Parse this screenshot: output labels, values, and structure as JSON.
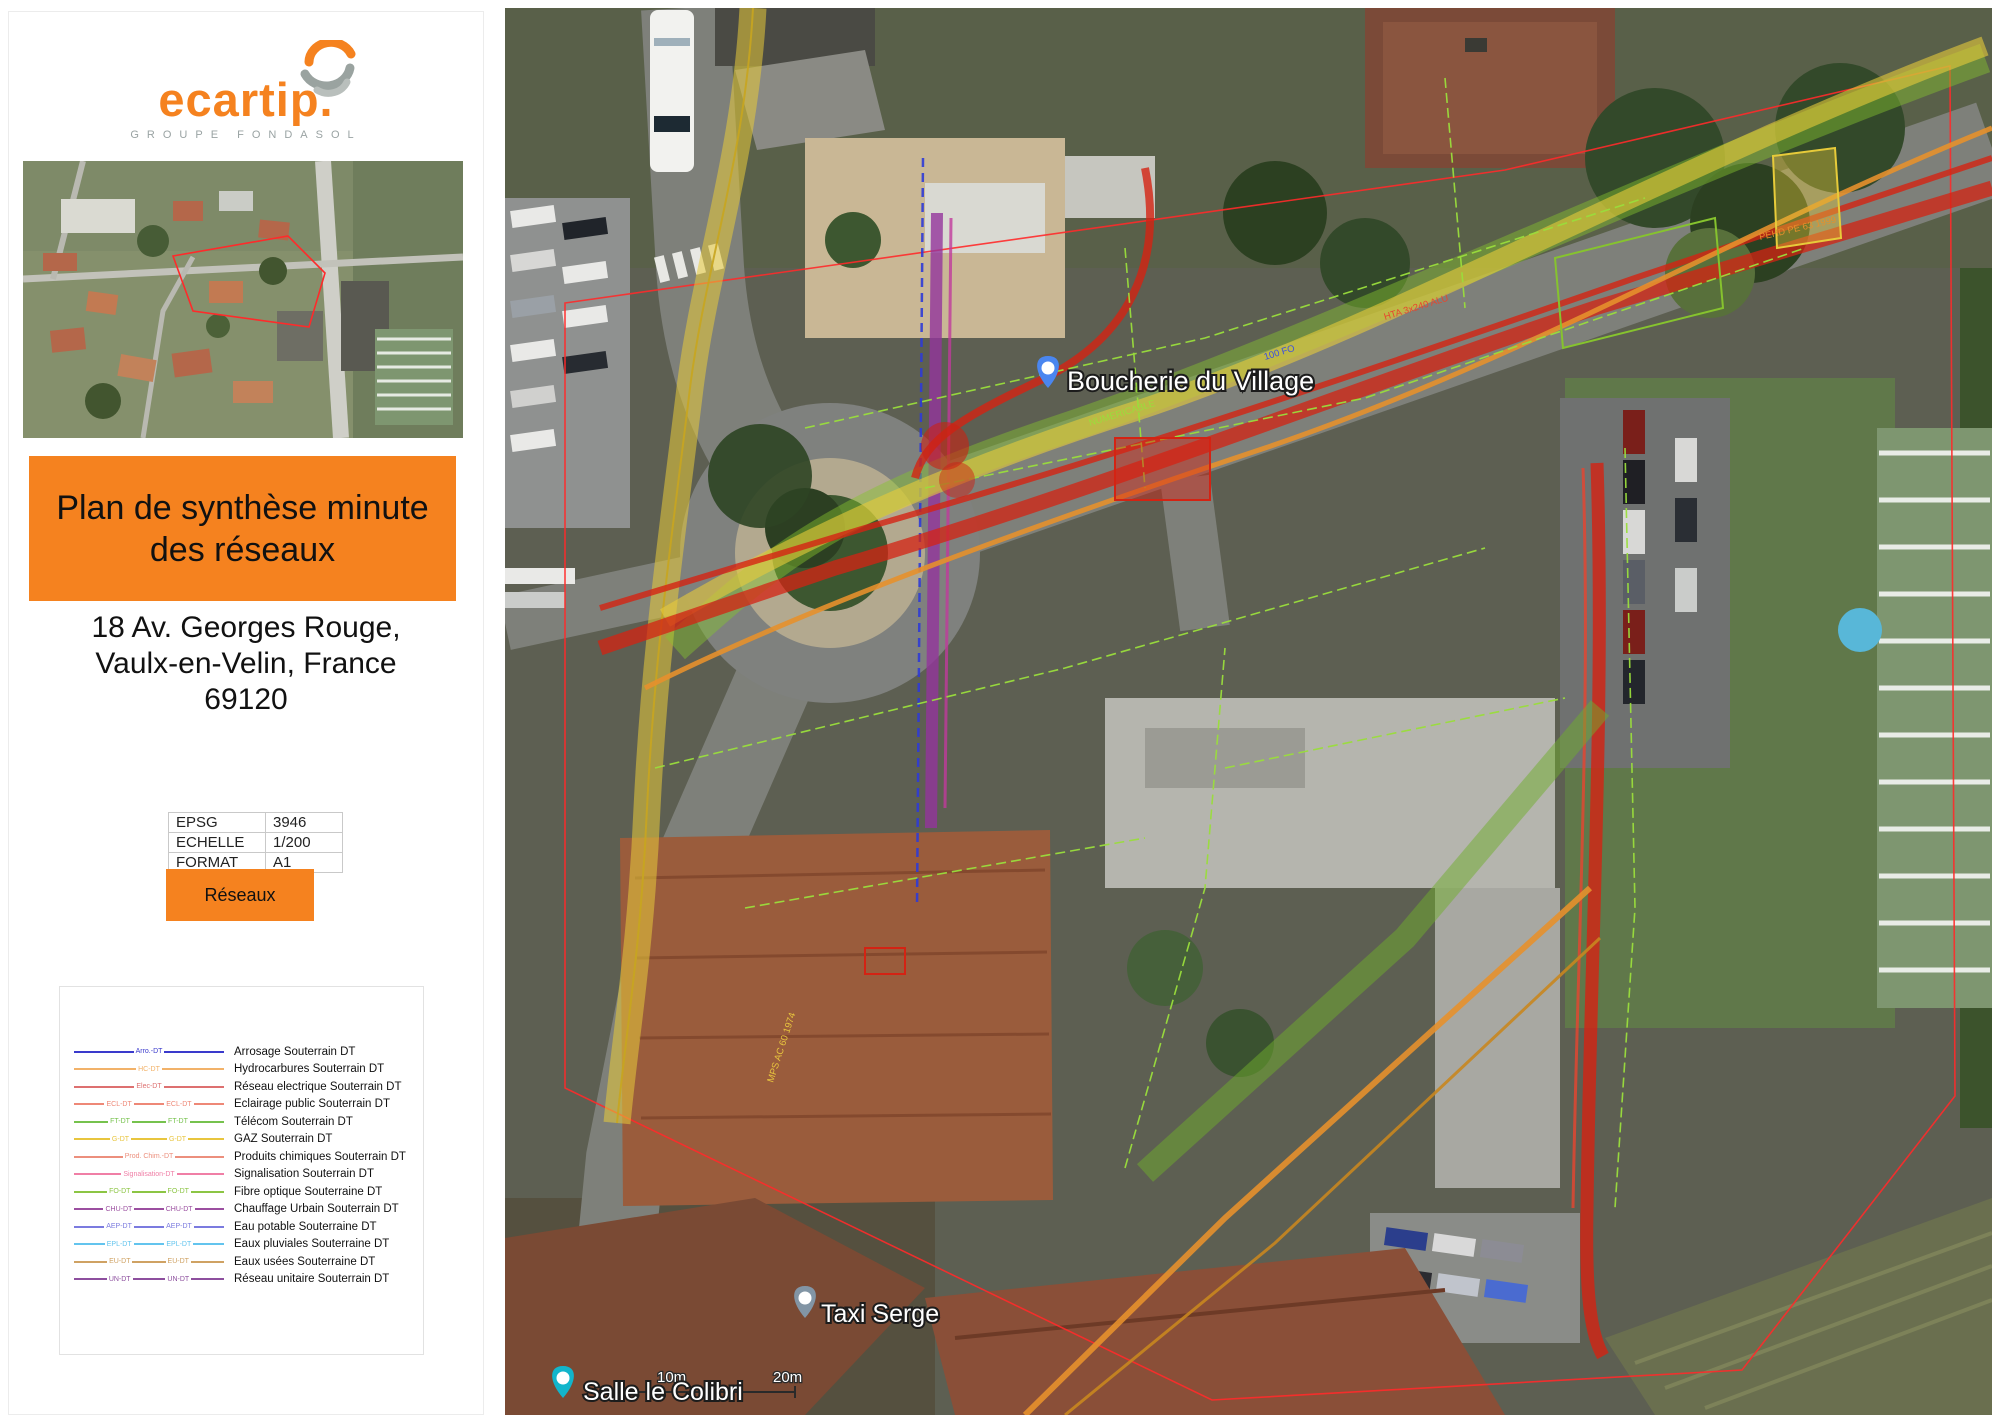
{
  "branding": {
    "logo_text": "ecartip.",
    "logo_sub": "GROUPE FONDASOL"
  },
  "title": {
    "line1": "Plan de synthèse minute",
    "line2": "des réseaux"
  },
  "address": {
    "line1": "18 Av. Georges Rouge,",
    "line2": "Vaulx-en-Velin, France",
    "line3": "69120"
  },
  "info_table": {
    "rows": [
      {
        "key": "EPSG",
        "value": "3946"
      },
      {
        "key": "ECHELLE",
        "value": "1/200"
      },
      {
        "key": "FORMAT",
        "value": "A1"
      }
    ]
  },
  "reseaux_button": "Réseaux",
  "legend": {
    "items": [
      {
        "code": "Arro.-DT",
        "label": "Arrosage Souterrain DT",
        "color": "#3a3acc",
        "repeat": false
      },
      {
        "code": "HC-DT",
        "label": "Hydrocarbures Souterrain DT",
        "color": "#f2b269",
        "repeat": false
      },
      {
        "code": "Elec-DT",
        "label": "Réseau electrique Souterrain DT",
        "color": "#dd7070",
        "repeat": false
      },
      {
        "code": "ECL-DT",
        "label": "Eclairage public Souterrain DT",
        "color": "#ee8877",
        "repeat": true
      },
      {
        "code": "FT-DT",
        "label": "Télécom Souterrain DT",
        "color": "#76c24d",
        "repeat": true
      },
      {
        "code": "G-DT",
        "label": "GAZ Souterrain DT",
        "color": "#e8c53e",
        "repeat": true
      },
      {
        "code": "Prod. Chim.-DT",
        "label": "Produits chimiques Souterrain DT",
        "color": "#ec8f7d",
        "repeat": false
      },
      {
        "code": "Signalisation-DT",
        "label": "Signalisation Souterrain DT",
        "color": "#f07fa6",
        "repeat": false
      },
      {
        "code": "FO-DT",
        "label": "Fibre optique Souterraine DT",
        "color": "#8cc544",
        "repeat": true
      },
      {
        "code": "CHU-DT",
        "label": "Chauffage Urbain Souterrain DT",
        "color": "#9b4fa0",
        "repeat": true
      },
      {
        "code": "AEP-DT",
        "label": "Eau potable Souterraine DT",
        "color": "#7b7bdf",
        "repeat": true
      },
      {
        "code": "EPL-DT",
        "label": "Eaux pluviales Souterraine DT",
        "color": "#63c4ee",
        "repeat": true
      },
      {
        "code": "EU-DT",
        "label": "Eaux usées Souterraine DT",
        "color": "#cfa263",
        "repeat": true
      },
      {
        "code": "UN-DT",
        "label": "Réseau unitaire Souterrain DT",
        "color": "#8d4f9e",
        "repeat": true
      }
    ]
  },
  "map": {
    "labels": [
      {
        "text": "Boucherie du Village",
        "pin": "shop-pin",
        "pin_color": "#4a86f0",
        "x": 543,
        "y": 362,
        "tx": 562,
        "ty": 382,
        "size": 27
      },
      {
        "text": "Taxi Serge",
        "pin": "taxi-pin",
        "pin_color": "#8295a5",
        "x": 300,
        "y": 1292,
        "tx": 316,
        "ty": 1314,
        "size": 25
      },
      {
        "text": "Salle le Colibri",
        "pin": "landmark-pin",
        "pin_color": "#12b5cb",
        "x": 58,
        "y": 1372,
        "tx": 78,
        "ty": 1392,
        "size": 25
      }
    ],
    "scale": {
      "m10": "10m",
      "m20": "20m"
    },
    "annotations": [
      {
        "text": "NUMERICABLE",
        "color": "#9ade3c",
        "x": 585,
        "y": 418,
        "rot": -17
      },
      {
        "text": "HTA 3x240 ALU",
        "color": "#e8452f",
        "x": 880,
        "y": 312,
        "rot": -17
      },
      {
        "text": "MPS AC 60 1974",
        "color": "#e8c53e",
        "x": 268,
        "y": 1075,
        "rot": -72
      },
      {
        "text": "PEHD PE 63 1999",
        "color": "#e6902c",
        "x": 1255,
        "y": 232,
        "rot": -13
      },
      {
        "text": "100 FO",
        "color": "#3c50e0",
        "x": 760,
        "y": 352,
        "rot": -17
      }
    ]
  },
  "colors": {
    "accent_orange": "#F5821F",
    "boundary_red": "#ff2a2a"
  }
}
